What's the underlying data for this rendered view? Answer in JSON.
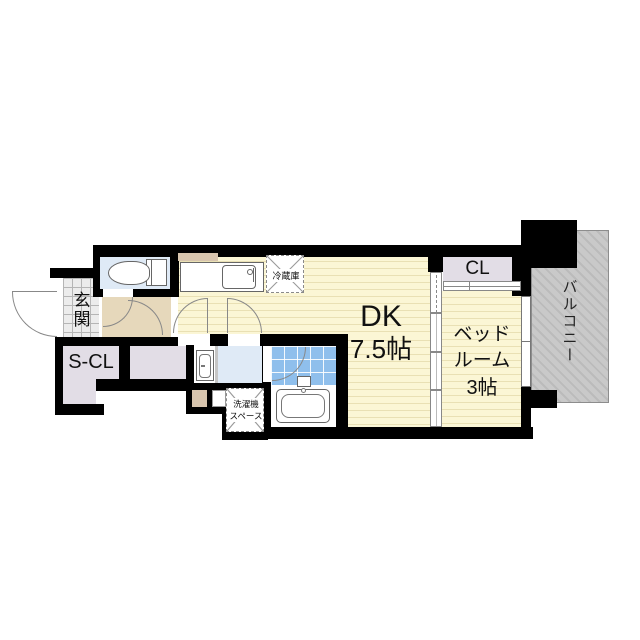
{
  "title": "apartment-floor-plan",
  "rooms": {
    "entrance": {
      "label": "玄関"
    },
    "shoe_closet": {
      "label": "S-CL"
    },
    "closet": {
      "label": "CL"
    },
    "dining_kitchen": {
      "label": "DK",
      "size": "7.5帖"
    },
    "bedroom": {
      "label_line1": "ベッド",
      "label_line2": "ルーム",
      "size": "3帖"
    },
    "balcony": {
      "label": "バルコニー"
    }
  },
  "fixtures": {
    "refrigerator": {
      "label": "冷蔵庫"
    },
    "washer_space": {
      "line1": "洗濯機",
      "line2": "スペース"
    }
  },
  "colors": {
    "wall": "#000000",
    "flooring": "#FBF6D5",
    "flooring_stripe": "#E9E0B4",
    "hallway": "#E6D8BB",
    "closet": "#E2DDE6",
    "sanitary": "#DFEAF6",
    "bath_tile": "#8FBFEC",
    "balcony": "#C9C9C9",
    "entrance_tile": "#ECECEC",
    "wood_accent": "#D8C5AE"
  }
}
